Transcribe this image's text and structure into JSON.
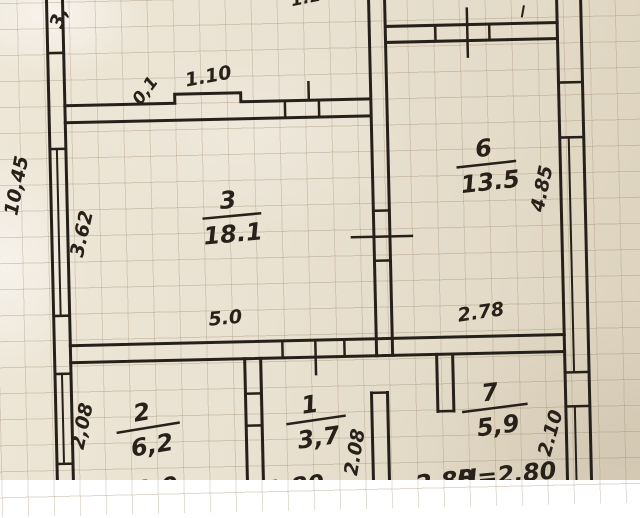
{
  "rooms": [
    {
      "number": "3",
      "area": "18.1"
    },
    {
      "number": "6",
      "area": "13.5"
    },
    {
      "number": "2",
      "area": "6,2"
    },
    {
      "number": "1",
      "area": "3,7"
    },
    {
      "number": "7",
      "area": "5,9"
    }
  ],
  "dimensions": {
    "left_outer_total": "10,45",
    "left_window": "3.62",
    "top_left_partial": "3,",
    "wall_step_depth": "0,1",
    "wall_step_width": "1.10",
    "top_mid_partial": "1.10",
    "mid_wall_left": "5.0",
    "mid_wall_right": "2.78",
    "right_window": "4.85",
    "room2_depth": "2,08",
    "room1_depth": "2.08",
    "room7_depth": "2.10",
    "room2_width": "3.0",
    "room1_width": "1.80",
    "room7_width": "2.80",
    "ceiling_height": "H=2.80"
  }
}
